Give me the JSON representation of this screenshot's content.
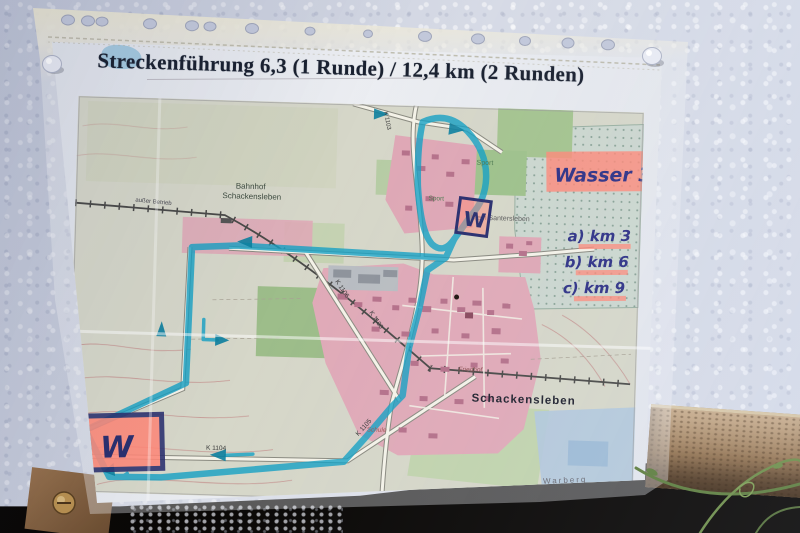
{
  "title": "Streckenführung 6,3 (1 Runde) / 12,4 km (2 Runden)",
  "annotations": {
    "water_note": "Wasser 3x",
    "km_marks": [
      "a) km 3",
      "b) km 6",
      "c) km 9"
    ],
    "exclamation": "!",
    "water_station_top": "W",
    "water_station_bottom": "W"
  },
  "map": {
    "labels": {
      "bahnhof_line1": "Bahnhof",
      "bahnhof_line2": "Schackensleben",
      "ausser_betrieb": "außer Betrieb",
      "klein_santersleben": "Klein Santersleben",
      "sport_upper": "Sport",
      "sport_lower": "Sport",
      "town": "Schackensleben",
      "friedhof": "Friedhof",
      "schule": "Schule",
      "warberg": "Warberg"
    },
    "roads": {
      "k1100": "K 1100",
      "k1103": "K 1103",
      "k1104": "K 1104",
      "k1105": "K 1105",
      "k1106": "K 1106"
    }
  },
  "colors": {
    "route_highlighter": "#15a0c3",
    "pink_highlighter": "#ff8878",
    "marker_ink": "#2f3286",
    "map_urban_pink": "#dfa8b6",
    "map_field_green": "#a5c490",
    "paper": "#e7e9ee",
    "wall": "#ccd1df"
  }
}
